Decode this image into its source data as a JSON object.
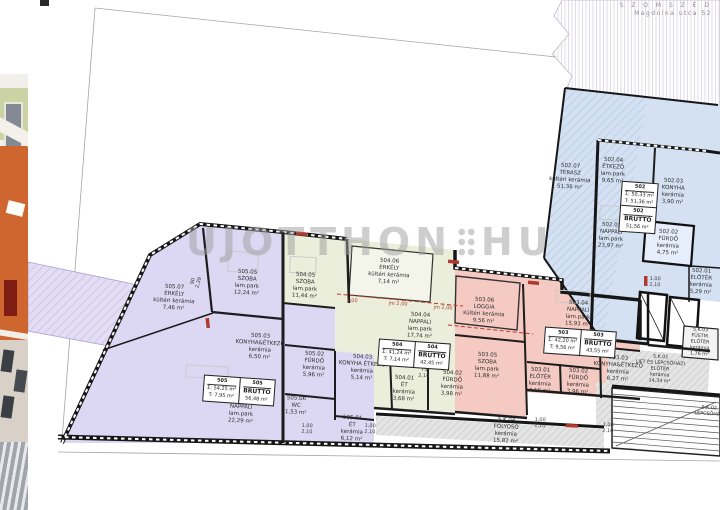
{
  "neighbor": {
    "line1": "S Z O M S Z É D",
    "line2": "Magdolna utca 52"
  },
  "watermark": {
    "left": "UJOTTHON",
    "right": "HU"
  },
  "apartments": [
    {
      "id": "505",
      "sum": "Σ: 54,25 m²",
      "terrace": "T: 7,95 m²",
      "brutto_label": "BRUTTÓ",
      "brutto": "56,48 m²"
    },
    {
      "id": "504",
      "sum": "Σ: 41,24 m²",
      "terrace": "T: 7,14 m²",
      "brutto_label": "BRUTTÓ",
      "brutto": "42,45 m²"
    },
    {
      "id": "503",
      "sum": "Σ: 42,20 m²",
      "terrace": "T: 9,56 m²",
      "brutto_label": "BRUTTÓ",
      "brutto": "43,55 m²"
    },
    {
      "id": "502",
      "sum": "Σ: 50,33 m²",
      "terrace": "T: 51,36 m²",
      "brutto_label": "BRUTTÓ",
      "brutto": "51,56 m²"
    }
  ],
  "rooms": [
    {
      "label": "505.07\nERKÉLY\nkültéri kerámia\n7,46 m²"
    },
    {
      "label": "505.05\nSZOBA\nlam.park\n12,24 m²"
    },
    {
      "label": "505.03\nKONYHA&ÉTKEZŐ\nkerámia\n6,50 m²"
    },
    {
      "label": "505.04\nNAPPALI\nlam.park\n22,29 m²"
    },
    {
      "label": "505.02\nFÜRDŐ\nkerámia\n5,96 m²"
    },
    {
      "label": "505.06\nWC\n1,53 m²"
    },
    {
      "label": "505.01\nÉT\nkerámia\n6,12 m²"
    },
    {
      "label": "504.05\nSZOBA\nlam.park\n11,44 m²"
    },
    {
      "label": "504.06\nERKÉLY\nkültéri kerámia\n7,14 m²"
    },
    {
      "label": "504.04\nNAPPALI\nlam.park\n17,74 m²"
    },
    {
      "label": "504.03\nKONYHA ÉTKEZŐ\nkerámia\n5,14 m²"
    },
    {
      "label": "504.01\nÉT\nkerámia\n3,68 m²"
    },
    {
      "label": "504.02\nFÜRDŐ\nkerámia\n3,98 m²"
    },
    {
      "label": "503.06\nLOGGIA\nkültéri kerámia\n9,56 m²"
    },
    {
      "label": "503.04\nNAPPALI\nlam.park\n15,93 m²"
    },
    {
      "label": "503.05\nSZOBA\nlam.park\n11,88 m²"
    },
    {
      "label": "503.01\nELŐTÉR\nkerámia\n4,16 m²"
    },
    {
      "label": "503.02\nFÜRDŐ\nkerámia\n3,96 m²"
    },
    {
      "label": "503.03\nKONYHA&ÉTKEZŐ\nkerámia\n6,27 m²"
    },
    {
      "label": "502.07\nTERASZ\nkültéri kerámia\n51,36 m²"
    },
    {
      "label": "502.04\nÉTKEZŐ\nlam.park\n9,65 m²"
    },
    {
      "label": "502.03\nKONYHA\nkerámia\n3,90 m²"
    },
    {
      "label": "502.05\nNAPPALI\nlam.park\n23,97 m²"
    },
    {
      "label": "502.02\nFÜRDŐ\nkerámia\n4,75 m²"
    },
    {
      "label": "502.01\nELŐTÉR\nkerámia\n5,29 m²"
    },
    {
      "label": "5.K.01\nLIFT ÉS LÉPCSŐHÁZI ELŐTÉR\nkerámia\n14,34 m²"
    },
    {
      "label": "5.K.04\nFOLYOSÓ\nkerámia\n15,82 m²"
    },
    {
      "label": "5.K.03\nFÜSTM. ELŐTÉR\nkerámia\n1,76 m²"
    },
    {
      "label": "5.K.02\nLÉPCSŐHÁZ"
    }
  ],
  "dims": [
    {
      "t": "90\n2,39"
    },
    {
      "t": "1,00\n2,10"
    },
    {
      "t": "1,00\n2,10"
    },
    {
      "t": "1,00\n2,10"
    },
    {
      "t": "1,00\n2,10"
    },
    {
      "t": "1,00\n2,10"
    },
    {
      "t": "75\n2,10"
    }
  ],
  "red_dims": [
    {
      "t": "1,00"
    },
    {
      "t": "jm 2,00"
    },
    {
      "t": "jm 2,00"
    }
  ],
  "colors": {
    "apartment_505": "#dcd7f2",
    "apartment_504": "#eaeeda",
    "apartment_503": "#f5cac3",
    "apartment_502": "#d3e1f2",
    "common_area": "#e4e4e4",
    "wall": "#1a1a1a",
    "red_accent": "#b03a2e",
    "watermark_gray": "#9f9f9f"
  }
}
